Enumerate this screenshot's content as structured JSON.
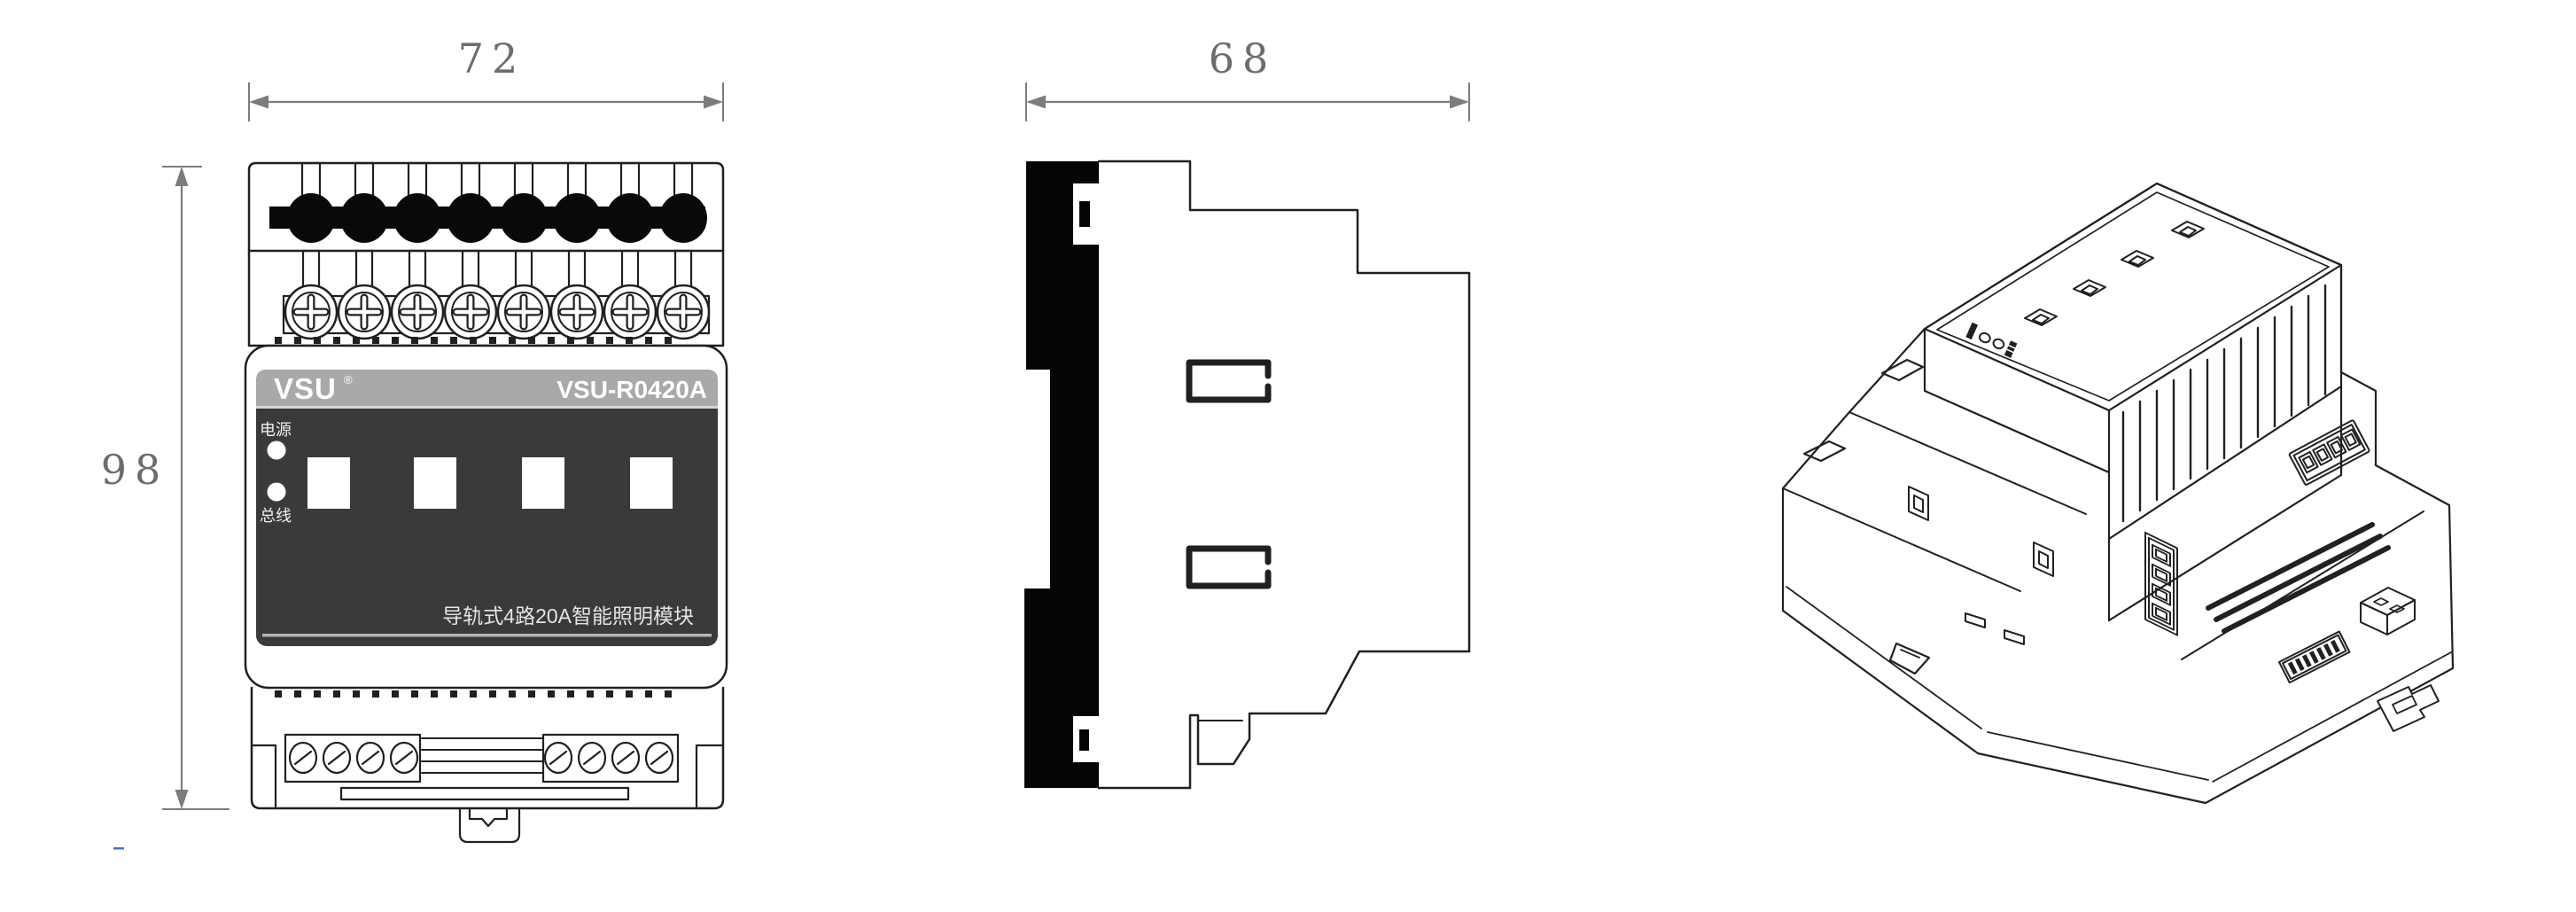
{
  "page": {
    "background": "#ffffff",
    "line_color": "#231f1d"
  },
  "dimensions": {
    "front_width_label": "72",
    "front_height_label": "98",
    "side_depth_label": "68",
    "line_color": "#7c7c7c",
    "text_color": "#6f6b6b"
  },
  "front_view": {
    "brand": "VSU",
    "brand_registered_mark": "®",
    "model": "VSU-R0420A",
    "power_led_label": "电源",
    "bus_led_label": "总线",
    "bottom_caption": "导轨式4路20A智能照明模块",
    "panel_color": "#3b3a39",
    "header_bar_color": "#a9a9a9",
    "top_terminal_count": 8,
    "screw_terminal_count": 8,
    "channel_button_count": 4,
    "bottom_screw_count": 8
  },
  "artifact": {
    "dash_color": "#4a72c4"
  }
}
